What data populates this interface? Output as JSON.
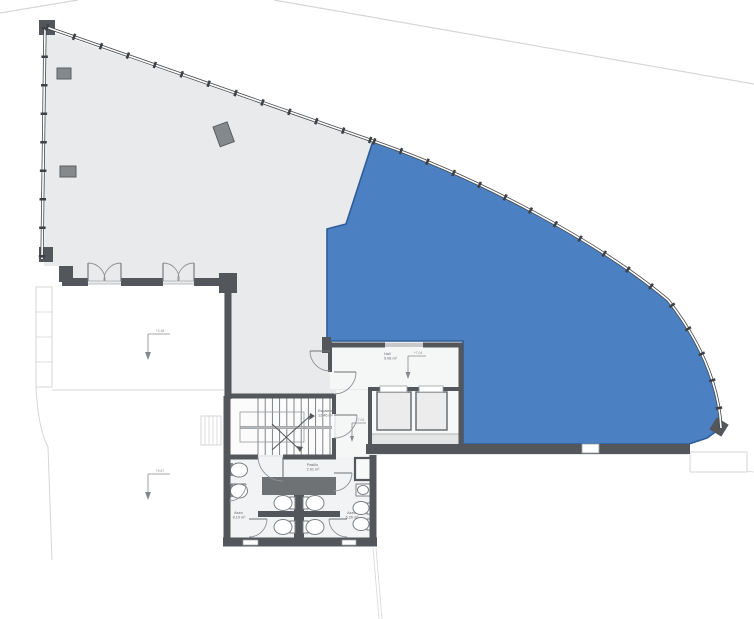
{
  "plan_title": "floor-plan",
  "colors": {
    "highlight": "#4b81c2",
    "highlight_border": "#2d5d99",
    "floor": "#e9eaeb",
    "wall": "#53575b",
    "room_fill": "#f5f6f6"
  },
  "rooms": {
    "hall": {
      "name": "Hall",
      "area": "9.08 m²"
    },
    "stairs": {
      "name": "Escaleras",
      "area": "12.46 m²"
    },
    "corridor": {
      "name": "Pasillo",
      "area": "2.91 m²"
    },
    "aseo_left": {
      "name": "Aseo",
      "area": "8.10 m²"
    },
    "aseo_right": {
      "name": "Aseo",
      "area": "6.26 m²"
    }
  },
  "levels": {
    "upper_left": "+3.38",
    "lower_left": "+5.67",
    "hall": "+7.04",
    "corridor": "+7.04"
  }
}
